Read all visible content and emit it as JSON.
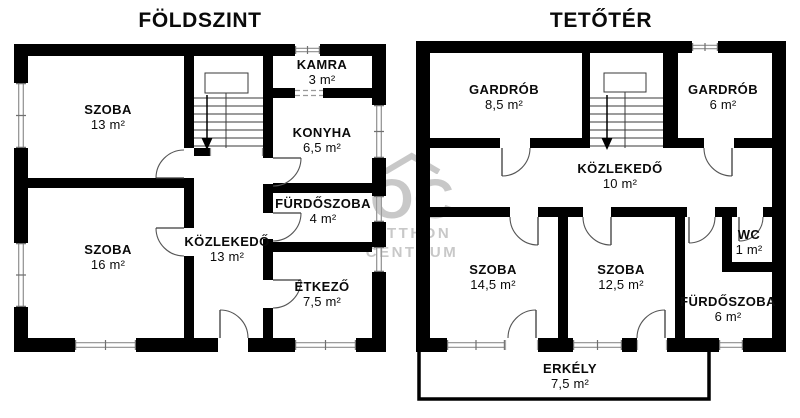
{
  "plans": [
    {
      "id": "ground-floor",
      "title": "FÖLDSZINT",
      "rooms": [
        {
          "name": "SZOBA",
          "area": "13 m²"
        },
        {
          "name": "KAMRA",
          "area": "3 m²"
        },
        {
          "name": "KONYHA",
          "area": "6,5 m²"
        },
        {
          "name": "FÜRDŐSZOBA",
          "area": "4 m²"
        },
        {
          "name": "SZOBA",
          "area": "16 m²"
        },
        {
          "name": "KÖZLEKEDŐ",
          "area": "13 m²"
        },
        {
          "name": "ÉTKEZŐ",
          "area": "7,5 m²"
        }
      ]
    },
    {
      "id": "attic-floor",
      "title": "TETŐTÉR",
      "rooms": [
        {
          "name": "GARDRÓB",
          "area": "8,5 m²"
        },
        {
          "name": "GARDRÓB",
          "area": "6 m²"
        },
        {
          "name": "KÖZLEKEDŐ",
          "area": "10 m²"
        },
        {
          "name": "SZOBA",
          "area": "14,5 m²"
        },
        {
          "name": "SZOBA",
          "area": "12,5 m²"
        },
        {
          "name": "WC",
          "area": "1 m²"
        },
        {
          "name": "FÜRDŐSZOBA",
          "area": "6 m²"
        },
        {
          "name": "ERKÉLY",
          "area": "7,5 m²"
        }
      ]
    }
  ],
  "watermark": {
    "monogram": "OC",
    "line1": "OTTHON",
    "line2": "CENTRUM"
  },
  "colors": {
    "wall": "#000000",
    "window_line": "#8f8f8f",
    "door_line": "#555555",
    "watermark": "#c8c8c8"
  }
}
